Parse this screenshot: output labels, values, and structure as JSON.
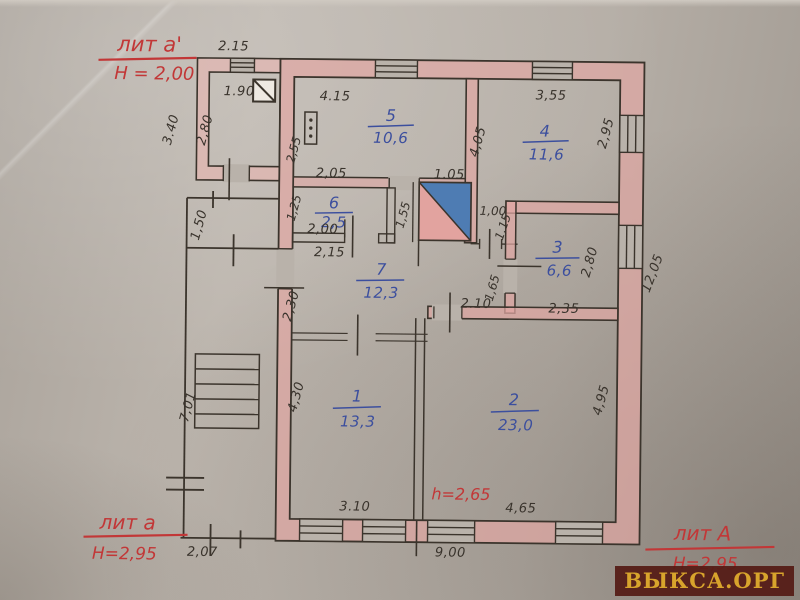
{
  "watermark": "ВЫКСА.ОРГ",
  "liters": {
    "annex_upper": {
      "label": "лит а'",
      "height": "Н = 2,00"
    },
    "annex_lower": {
      "label": "лит а",
      "height": "Н=2,95"
    },
    "main": {
      "label": "лит А",
      "height": "Н=2,95"
    }
  },
  "ceiling_note": "h=2,65",
  "rooms": [
    {
      "number": "5",
      "area": "10,6"
    },
    {
      "number": "4",
      "area": "11,6"
    },
    {
      "number": "6",
      "area": "2,5"
    },
    {
      "number": "3",
      "area": "6,6"
    },
    {
      "number": "7",
      "area": "12,3"
    },
    {
      "number": "1",
      "area": "13,3"
    },
    {
      "number": "2",
      "area": "23,0"
    }
  ],
  "dimensions": {
    "annex_top_width": "2.15",
    "annex_inner_width": "1.90",
    "annex_outer_height": "3.40",
    "annex_inner_height": "2,80",
    "room5_width": "4.15",
    "room5_height": "2,55",
    "room4_width": "3,55",
    "room4_height": "4,05",
    "room4_window": "2,95",
    "room6_width": "2,05",
    "room6_height": "1,25",
    "room6_inner": "2,00",
    "room6_below": "2,15",
    "stair_width": "1.05",
    "stair_height": "1,55",
    "door_width": "1,00",
    "door_depth": "1,15",
    "room3_window": "2,80",
    "room3_width": "2,35",
    "room3_door": "1,65",
    "building_depth": "12,05",
    "hall_height": "2,30",
    "hall_door": "2.10",
    "corridor_width": "1,50",
    "corridor_height": "7,01",
    "room1_height": "4,30",
    "room1_window": "3.10",
    "room2_height": "4,95",
    "room2_window": "4,65",
    "building_width": "9,00",
    "porch_width": "2,07"
  },
  "colors": {
    "wall_fill": "#e0a7a3",
    "annex_fill": "#e6b5b1",
    "ink": "#3b342c",
    "room_ink": "#3c4f9e",
    "red_ink": "#c23737",
    "stair_blue": "#4e7cb3",
    "paper": "#b9b2aa",
    "watermark_bg": "#541a14",
    "watermark_fg": "#d8a42c"
  }
}
